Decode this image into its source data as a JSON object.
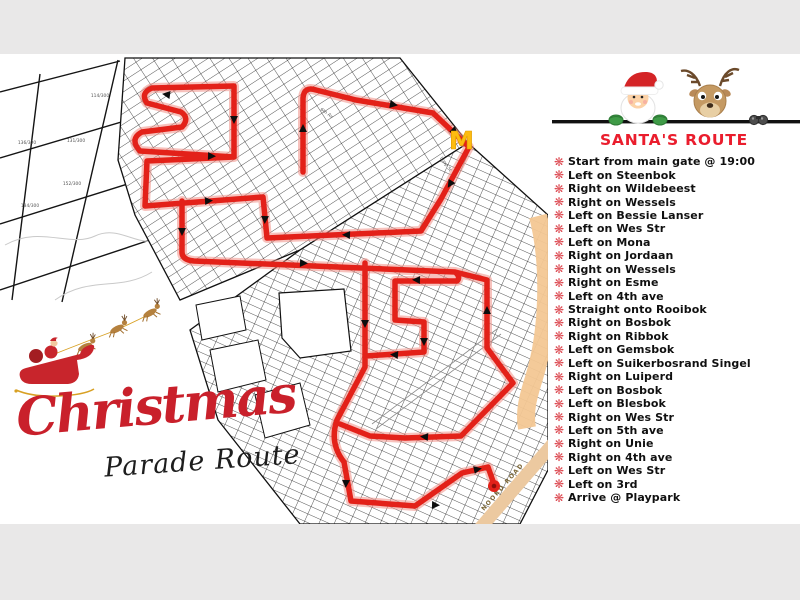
{
  "branding": {
    "script_title": "Christmas",
    "script_subtitle": "Parade Route"
  },
  "panel": {
    "title": "SANTA'S ROUTE",
    "bullet_glyph": "❋",
    "items": [
      "Start from main gate @ 19:00",
      "Left on Steenbok",
      "Right on Wildebeest",
      "Right on Wessels",
      "Left on Bessie Lanser",
      "Left on Wes Str",
      "Left on Mona",
      "Right on Jordaan",
      "Right on Wessels",
      "Right on Esme",
      "Left on 4th ave",
      "Straight onto Rooibok",
      "Right on Bosbok",
      "Right on Ribbok",
      "Left on Gemsbok",
      "Left on Suikerbosrand Singel",
      "Right on Luiperd",
      "Left on Bosbok",
      "Left on Blesbok",
      "Right on Wes Str",
      "Left on 5th ave",
      "Right on Unie",
      "Right on 4th ave",
      "Left on Wes Str",
      "Left on 3rd",
      "Arrive @ Playpark"
    ]
  },
  "map": {
    "plot_labels": [
      "114/300",
      "136/300",
      "131/300",
      "152/300",
      "134/300"
    ],
    "street_labels": {
      "loop_st": "Loop St",
      "sixth_av": "6th Av",
      "noord_road": "NOORD ROAD"
    },
    "mcdonalds_mark": "M"
  },
  "colors": {
    "route_red": "#e32119",
    "route_halo": "#f08f86",
    "title_red": "#ea1d2d",
    "bullet_red": "#dd4b53",
    "road_orange": "#f3c793",
    "letterbox_gray": "#e9e8e8"
  }
}
